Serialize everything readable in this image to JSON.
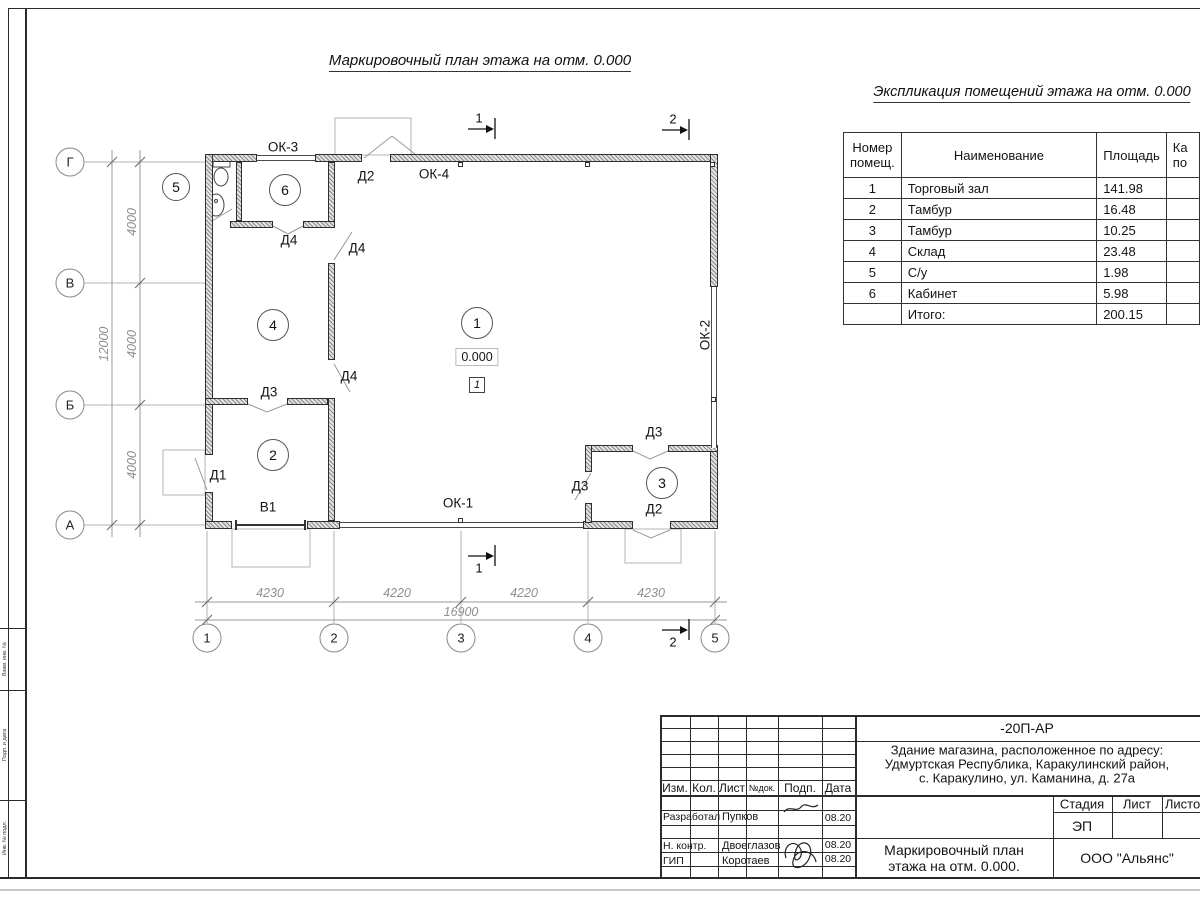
{
  "plan_title": "Маркировочный план этажа на отм. 0.000",
  "expl_table": {
    "title": "Экспликация помещений этажа на отм. 0.000",
    "headers": {
      "num_line1": "Номер",
      "num_line2": "помещ.",
      "name": "Наименование",
      "area": "Площадь",
      "cat_line1": "Ка",
      "cat_line2": "по"
    },
    "rows": [
      {
        "num": "1",
        "name": "Торговый зал",
        "area": "141.98"
      },
      {
        "num": "2",
        "name": "Тамбур",
        "area": "16.48"
      },
      {
        "num": "3",
        "name": "Тамбур",
        "area": "10.25"
      },
      {
        "num": "4",
        "name": "Склад",
        "area": "23.48"
      },
      {
        "num": "5",
        "name": "С/у",
        "area": "1.98"
      },
      {
        "num": "6",
        "name": "Кабинет",
        "area": "5.98"
      },
      {
        "num": "",
        "name": "Итого:",
        "area": "200.15"
      }
    ]
  },
  "plan": {
    "axis_letters": [
      "Г",
      "В",
      "Б",
      "А"
    ],
    "axis_numbers": [
      "1",
      "2",
      "3",
      "4",
      "5"
    ],
    "dims_bottom": [
      "4230",
      "4220",
      "4220",
      "4230"
    ],
    "dim_total_bottom": "16900",
    "dims_left": [
      "4000",
      "4000",
      "4000"
    ],
    "dim_total_left": "12000",
    "rooms": [
      "1",
      "2",
      "3",
      "4",
      "5",
      "6"
    ],
    "level_mark": "0.000",
    "floor_mark": "1",
    "doors": {
      "d1": "Д1",
      "d2": "Д2",
      "d3": "Д3",
      "d4": "Д4"
    },
    "windows": {
      "ok1": "ОК-1",
      "ok2": "ОК-2",
      "ok3": "ОК-3",
      "ok4": "ОК-4"
    },
    "gate": "В1",
    "section_marks": {
      "s1": "1",
      "s2": "2"
    }
  },
  "stamp": {
    "doc_code": "-20П-АР",
    "address_line1": "Здание магазина, расположенное по адресу:",
    "address_line2": "Удмуртская Республика, Каракулинский район,",
    "address_line3": "с. Каракулино, ул. Каманина, д. 27а",
    "cols": {
      "izm": "Изм.",
      "kol": "Кол.",
      "list": "Лист",
      "ndok": "№док.",
      "podp": "Подп.",
      "data": "Дата"
    },
    "stage_label": "Стадия",
    "sheet_label": "Лист",
    "sheets_label": "Листов",
    "stage_value": "ЭП",
    "rows": [
      {
        "role": "Разработал",
        "name": "Пупков",
        "date": "08.20"
      },
      {
        "role": "Н. контр.",
        "name": "Двоеглазов",
        "date": "08.20"
      },
      {
        "role": "ГИП",
        "name": "Коротаев",
        "date": "08.20"
      }
    ],
    "drawing_name_line1": "Маркировочный план",
    "drawing_name_line2": "этажа на отм. 0.000.",
    "company": "ООО \"Альянс\""
  },
  "frame": {
    "side_labels": [
      "Взам. инв. №",
      "Подп. и дата",
      "Инв. № подл."
    ]
  }
}
